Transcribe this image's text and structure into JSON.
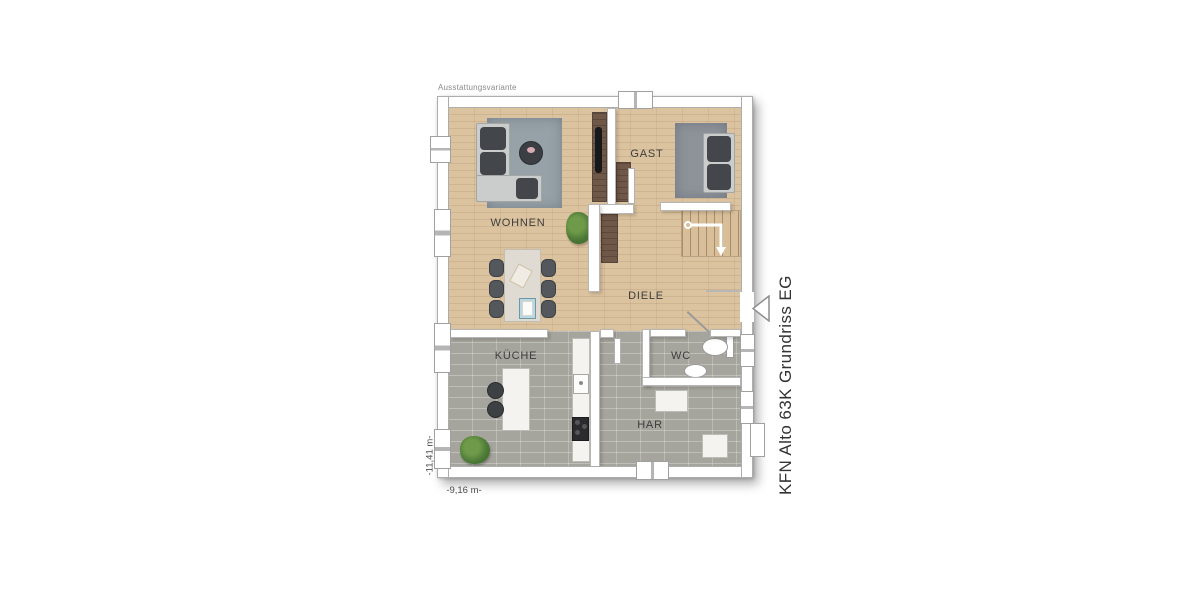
{
  "plan": {
    "variant_label": "Ausstattungsvariante",
    "side_title": "KFN Alto 63K Grundriss EG",
    "rooms": [
      {
        "id": "wohnen",
        "label": "WOHNEN"
      },
      {
        "id": "gast",
        "label": "GAST"
      },
      {
        "id": "diele",
        "label": "DIELE"
      },
      {
        "id": "kueche",
        "label": "KÜCHE"
      },
      {
        "id": "wc",
        "label": "WC"
      },
      {
        "id": "har",
        "label": "HAR"
      }
    ],
    "dimensions": {
      "width_label": "-9,16 m-",
      "height_label": "-11,41 m-"
    },
    "colors": {
      "background": "#ffffff",
      "wood_floor": "#dcc39f",
      "tile_floor": "#a6a59d",
      "wall_fill": "#ffffff",
      "wall_border": "#b6b6b6",
      "rug_wohnen": "#97a1a8",
      "rug_gast": "#8e939a",
      "sofa_body": "#cbcdcc",
      "sofa_cushion": "#43464a",
      "dark_wood_furniture": "#6f5848",
      "plant_green": "#4c7a37"
    }
  }
}
